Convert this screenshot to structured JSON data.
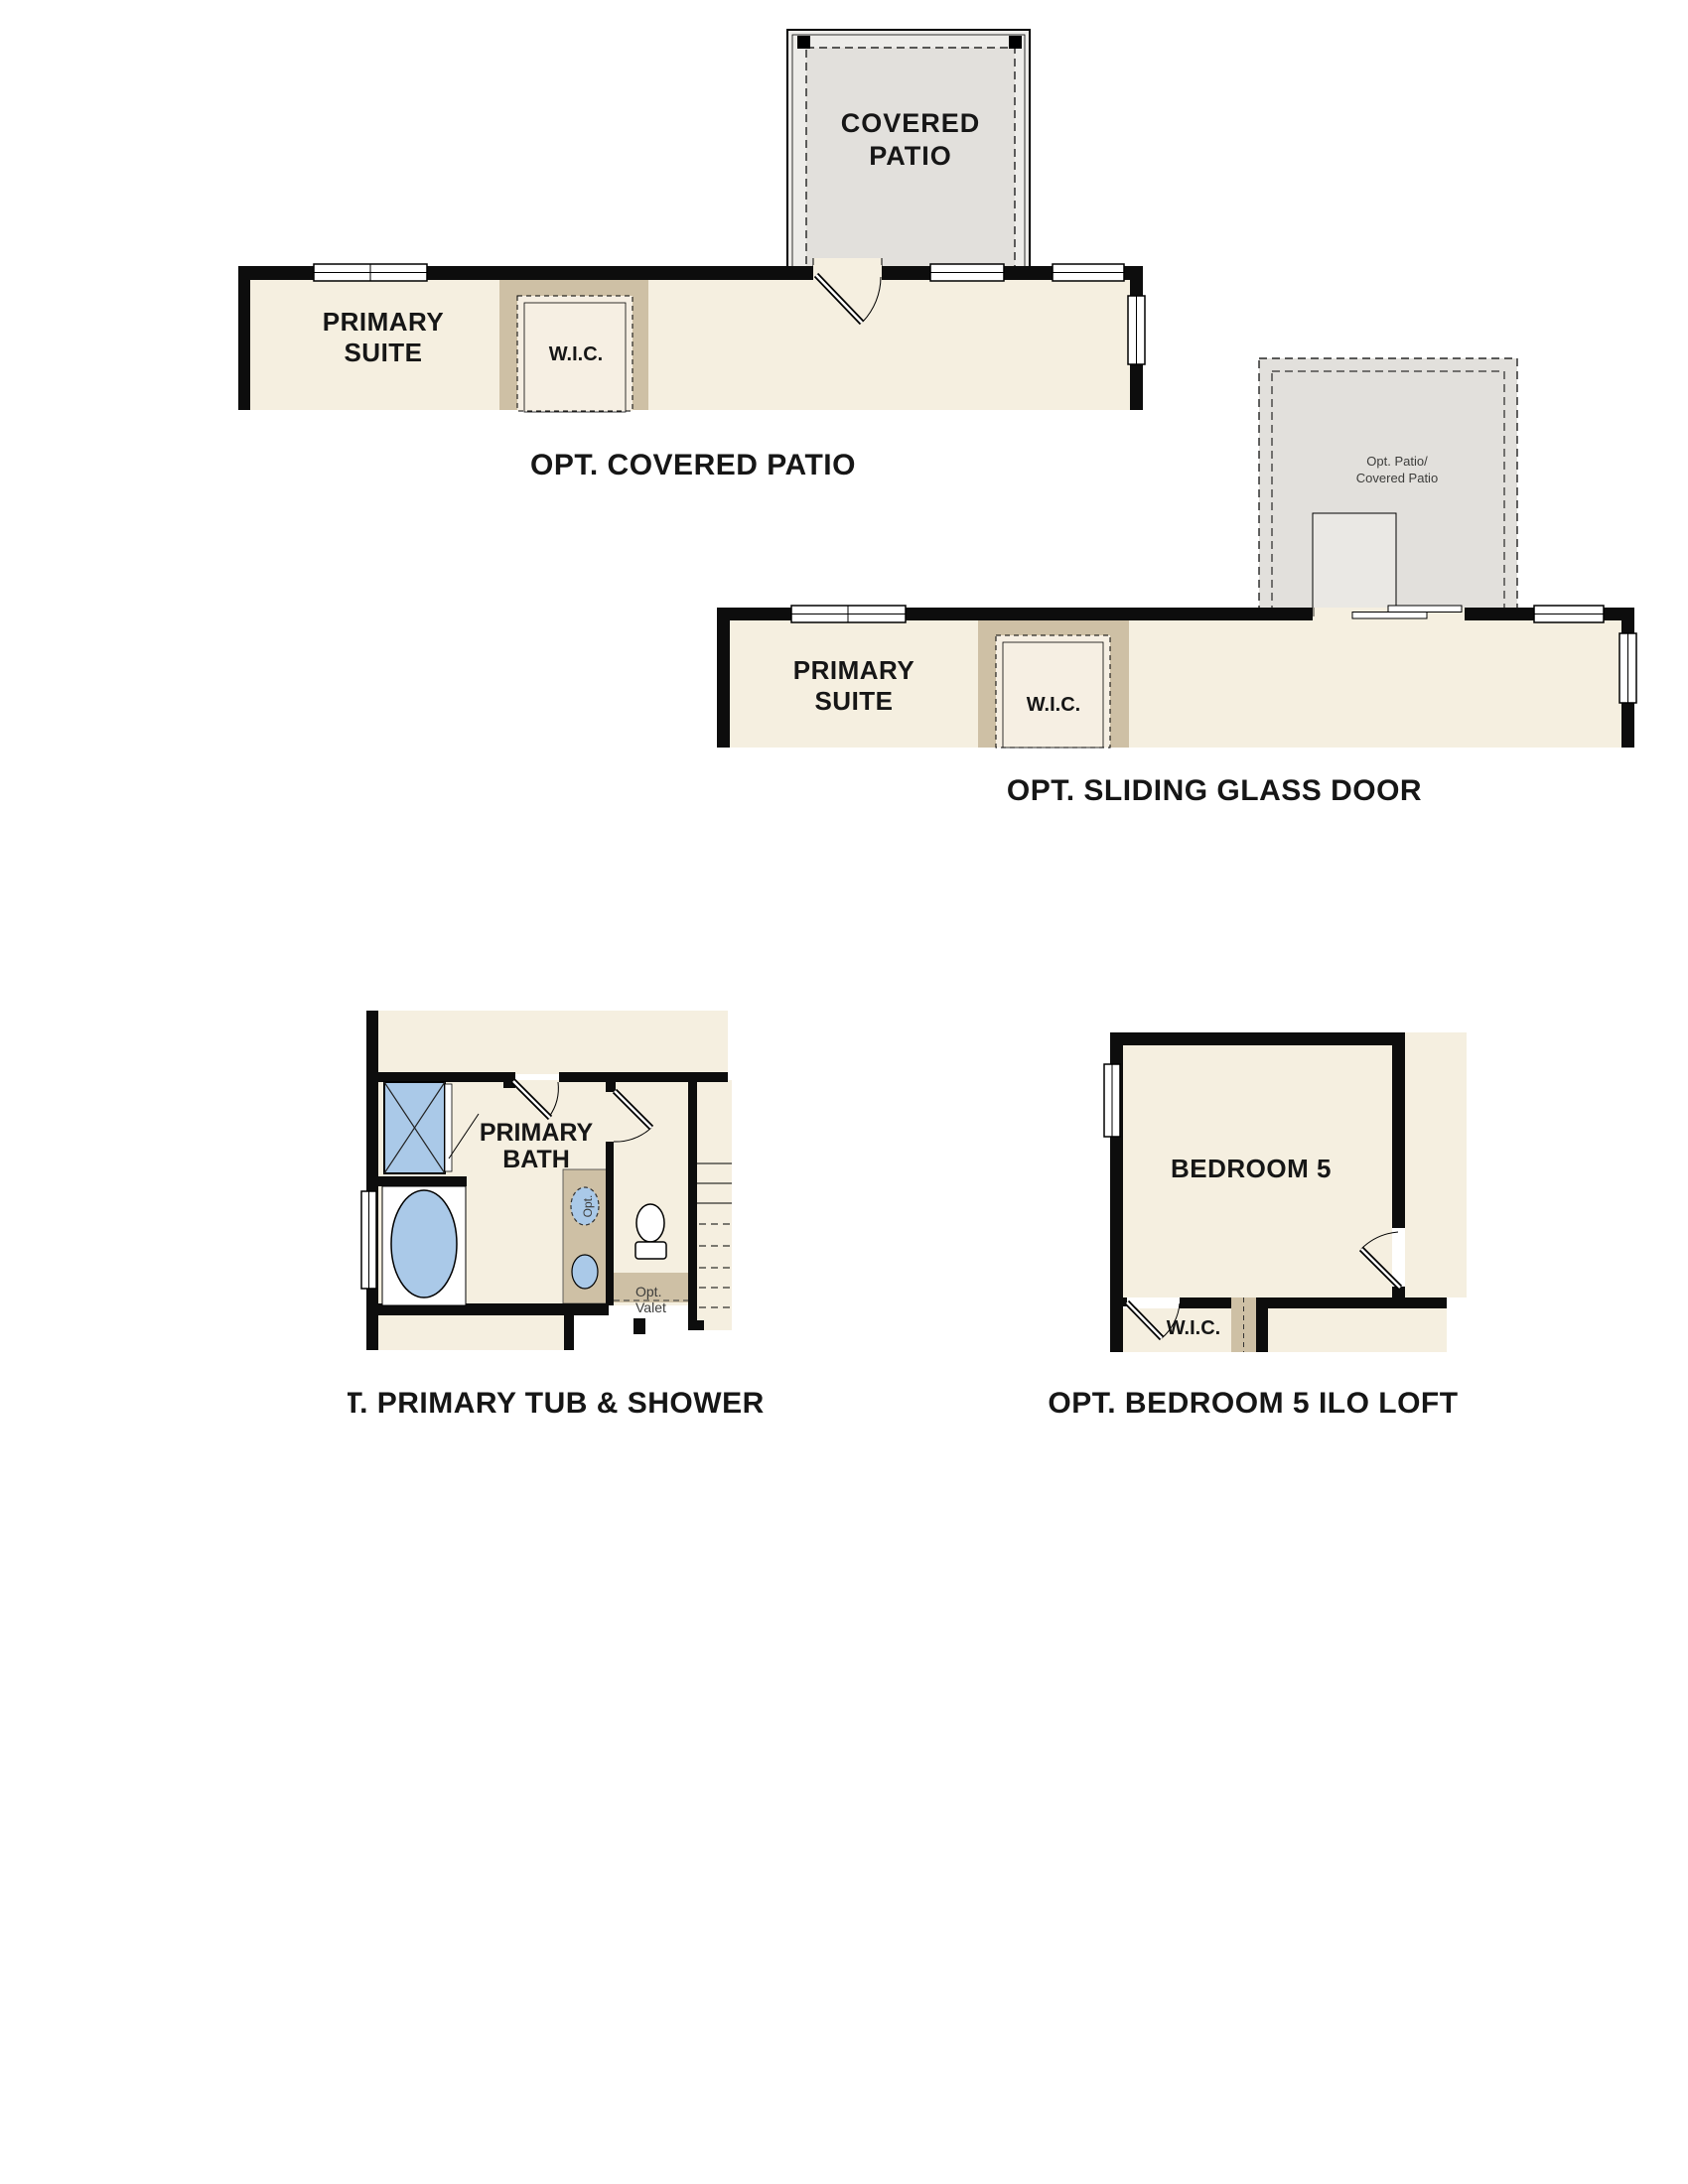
{
  "document": {
    "type": "floor-plan-options-sheet",
    "background": "#ffffff"
  },
  "colors": {
    "wall": "#0d0d0d",
    "cream": "#f5efe0",
    "tan": "#cec0a5",
    "wic_inner": "#f6efe3",
    "patio_gray": "#e2e0dc",
    "patio_light": "#edece9",
    "pad_gray": "#eae8e4",
    "fixture_blue": "#aac9e8",
    "note": "#3c3c3a"
  },
  "plan_covered_patio": {
    "caption": "OPT. COVERED PATIO",
    "patio_line1": "COVERED",
    "patio_line2": "PATIO",
    "suite_line1": "PRIMARY",
    "suite_line2": "SUITE",
    "closet": "W.I.C."
  },
  "plan_sliding_door": {
    "caption": "OPT. SLIDING GLASS DOOR",
    "suite_line1": "PRIMARY",
    "suite_line2": "SUITE",
    "closet": "W.I.C.",
    "patio_note_line1": "Opt. Patio/",
    "patio_note_line2": "Covered Patio"
  },
  "plan_tub_shower": {
    "caption": "OPT. PRIMARY TUB & SHOWER",
    "room_line1": "PRIMARY",
    "room_line2": "BATH",
    "valet_line1": "Opt.",
    "valet_line2": "Valet",
    "opt_sink": "Opt."
  },
  "plan_bedroom5": {
    "caption": "OPT. BEDROOM 5 ILO LOFT",
    "room": "BEDROOM 5",
    "closet": "W.I.C."
  }
}
